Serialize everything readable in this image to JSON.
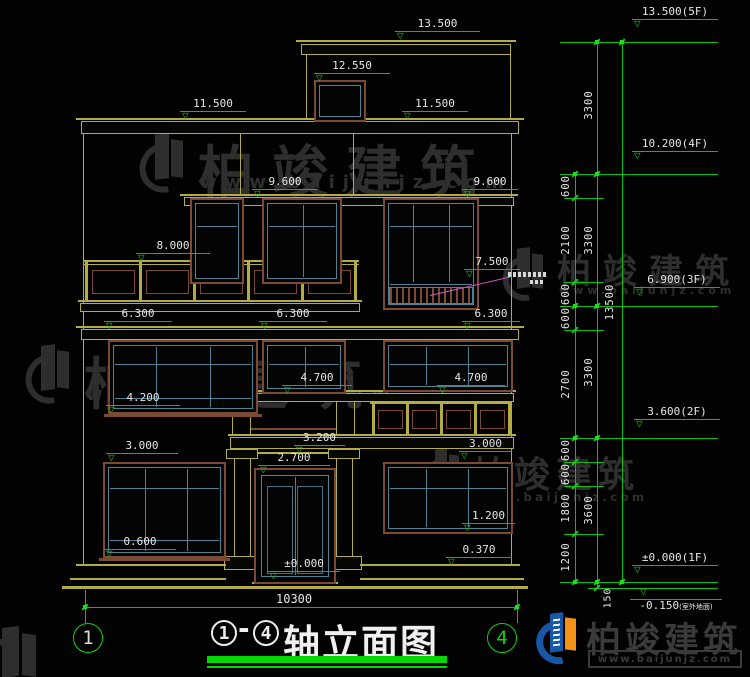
{
  "drawing": {
    "title": {
      "axis_from": "1",
      "separator": "-",
      "axis_to": "4",
      "name": "轴立面图"
    },
    "axis_bubbles": {
      "left": "1",
      "right": "4"
    }
  },
  "levels": {
    "v13_500": "13.500",
    "v12_550": "12.550",
    "v11_500": "11.500",
    "v9_600": "9.600",
    "v8_000": "8.000",
    "v7_500": "7.500",
    "v6_300": "6.300",
    "v4_700": "4.700",
    "v4_200": "4.200",
    "v3_200": "3.200",
    "v3_000": "3.000",
    "v2_700": "2.700",
    "v1_200": "1.200",
    "v0_600": "0.600",
    "v0_370": "0.370",
    "v0_000": "±0.000"
  },
  "floor_markers": {
    "f5": "13.500(5F)",
    "f4": "10.200(4F)",
    "f3": "6.900(3F)",
    "f2": "3.600(2F)",
    "f1": "±0.000(1F)",
    "outdoor": "-0.150",
    "outdoor_note": "(室外地面)"
  },
  "dim_segments": [
    "600",
    "2100",
    "600",
    "600",
    "2700",
    "600",
    "600",
    "1800",
    "1200"
  ],
  "floor_heights": [
    "3300",
    "3300",
    "3300",
    "3600"
  ],
  "dims_misc": {
    "total": "13500",
    "width": "10300",
    "ground": "150"
  },
  "watermark": {
    "brand": "柏竣建筑",
    "url": "www.baijunjz.com"
  },
  "colors": {
    "line_yellow": "#b3ac42",
    "line_green": "#0ac00a",
    "frame_brown": "#7b4a35",
    "frame_teal": "#4e8292",
    "text_white": "#e6e6e6",
    "leader_magenta": "#c957c9",
    "watermark_gray": "#2e2e2e",
    "logo_blue": "#1857a6",
    "logo_orange": "#f29318",
    "title_green": "#00d800"
  }
}
